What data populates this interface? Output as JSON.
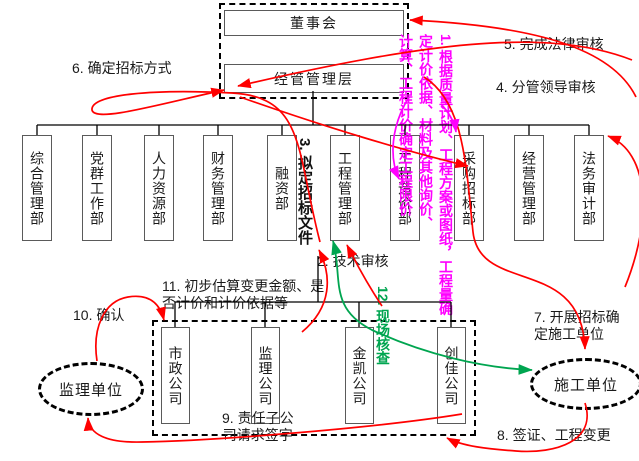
{
  "diagram": {
    "top": {
      "board": "董事会",
      "management": "经管管理层"
    },
    "departments": [
      "综合管理部",
      "党群工作部",
      "人力资源部",
      "财务管理部",
      "融资部",
      "工程管理部",
      "工程造价部",
      "采购招标部",
      "经营管理部",
      "法务审计部"
    ],
    "subsidiaries": [
      "市政公司",
      "监理公司",
      "金凯公司",
      "创佳公司"
    ],
    "ellipses": {
      "left": "监理单位",
      "right": "施工单位"
    },
    "annotations": {
      "a1_col1": "1. 根据质量计划、工程方案或图纸，工程量确",
      "a1_col2": "定计价依据、材料及其他询价、",
      "a1_col3": "计算、工程计价确定工程限价",
      "a2": "2. 技术审核",
      "a3": "3. 拟定招标文件",
      "a4": "4. 分管领导审核",
      "a5": "5. 完成法律审核",
      "a6": "6. 确定招标方式",
      "a7_line1": "7. 开展招标确",
      "a7_line2": "定施工单位",
      "a8": "8. 签证、工程变更",
      "a9_line1": "9. 责任子公",
      "a9_line2": "司请求签字",
      "a10": "10. 确认",
      "a11_line1": "11. 初步估算变更金额、是",
      "a11_line2": "否计价和计价依据等",
      "a12": "12. 现场核查"
    },
    "colors": {
      "arrow_red": "#ff0000",
      "arrow_green": "#00a550",
      "note_magenta": "#ff00ff",
      "structure_line": "#000000",
      "box_border": "#5a5a5a"
    }
  }
}
